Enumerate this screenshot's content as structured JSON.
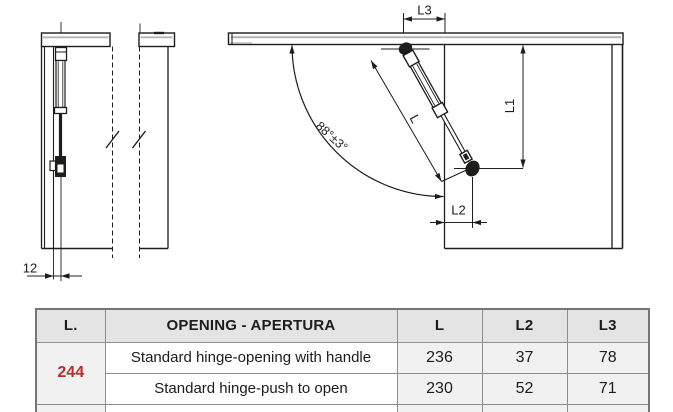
{
  "diagram": {
    "left_view": {
      "dim_offset": "12"
    },
    "right_view": {
      "dim_l3": "L3",
      "dim_l1": "L1",
      "dim_l": "L",
      "dim_l2": "L2",
      "dim_angle": "88°±3°"
    },
    "line_color": "#1d1d1b",
    "shade_color": "#b3b3b3"
  },
  "table": {
    "columns": [
      "L.",
      "OPENING - APERTURA",
      "L",
      "L2",
      "L3"
    ],
    "group": {
      "value": "244",
      "color": "#bf2a2c"
    },
    "rows": [
      {
        "opening": "Standard hinge-opening with handle",
        "l": "236",
        "l2": "37",
        "l3": "78"
      },
      {
        "opening": "Standard hinge-push to open",
        "l": "230",
        "l2": "52",
        "l3": "71"
      }
    ]
  }
}
